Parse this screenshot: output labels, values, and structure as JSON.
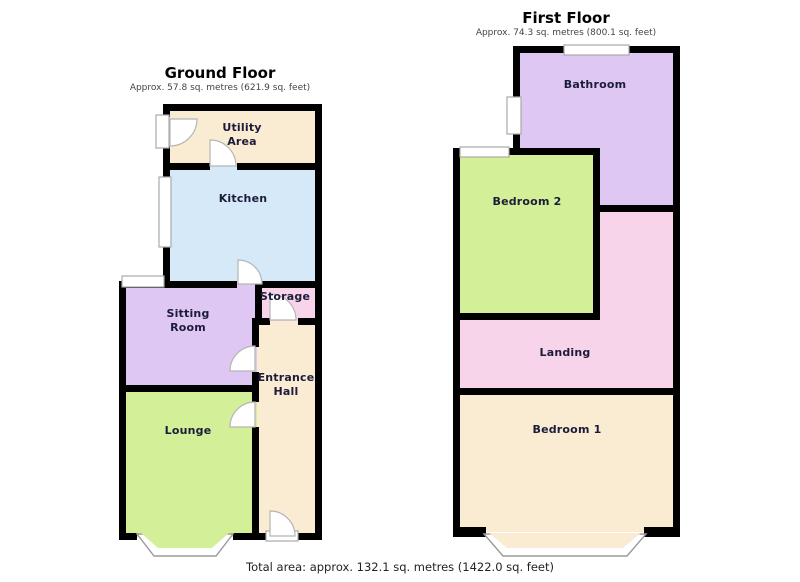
{
  "page": {
    "background": "#ffffff",
    "footer_total_area": "Total area: approx. 132.1 sq. metres (1422.0 sq. feet)"
  },
  "palette": {
    "wall": "#000000",
    "cream": "#faebd3",
    "blue": "#d6e9f8",
    "purple": "#dec7f2",
    "pink": "#f8d4ea",
    "green": "#d3f098",
    "frame_stroke": "#a9a9a9"
  },
  "floors": [
    {
      "title": "Ground Floor",
      "subtitle": "Approx. 57.8 sq. metres (621.9 sq. feet)",
      "rooms": [
        {
          "name": "Utility Area",
          "color_key": "cream"
        },
        {
          "name": "Kitchen",
          "color_key": "blue"
        },
        {
          "name": "Sitting Room",
          "color_key": "purple"
        },
        {
          "name": "Storage",
          "color_key": "pink"
        },
        {
          "name": "Entrance Hall",
          "color_key": "cream"
        },
        {
          "name": "Lounge",
          "color_key": "green"
        }
      ]
    },
    {
      "title": "First Floor",
      "subtitle": "Approx. 74.3 sq. metres (800.1 sq. feet)",
      "rooms": [
        {
          "name": "Bathroom",
          "color_key": "purple"
        },
        {
          "name": "Bedroom 2",
          "color_key": "green"
        },
        {
          "name": "Landing",
          "color_key": "pink"
        },
        {
          "name": "Bedroom 1",
          "color_key": "cream"
        }
      ]
    }
  ]
}
